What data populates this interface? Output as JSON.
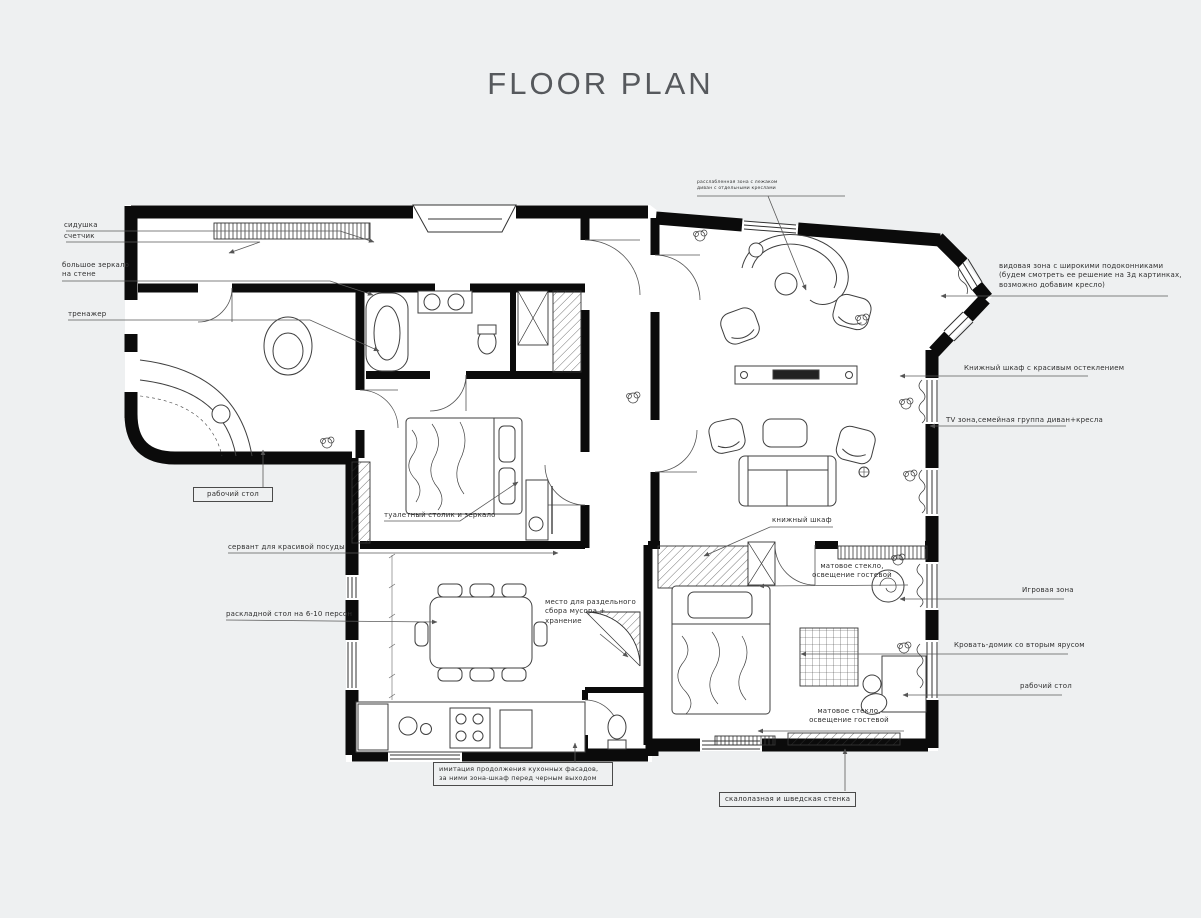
{
  "page": {
    "title": "FLOOR PLAN"
  },
  "colors": {
    "background": "#eef0f1",
    "paper": "#ffffff",
    "wall": "#0b0b0b",
    "furniture_line": "#3f3f3f",
    "leader_line": "#5a5a5a",
    "label_text": "#2f2f2f",
    "title_text": "#56595d"
  },
  "annotations": {
    "seat": {
      "text": "сидушка"
    },
    "meter": {
      "text": "счетчик"
    },
    "mirror": {
      "text": "большое зеркало\nна стене"
    },
    "trainer": {
      "text": "тренажер"
    },
    "desk_left": {
      "text": "рабочий стол"
    },
    "servant": {
      "text": "сервант для красивой посуды"
    },
    "folding_table": {
      "text": "раскладной стол на 6-10 персон"
    },
    "vanity": {
      "text": "туалетный столик и зеркало"
    },
    "waste": {
      "text": "место для раздельного\nсбора мусора +\nхранение"
    },
    "kitchen_facade": {
      "text": "имитация продолжения кухонных фасадов,\nза ними зона-шкаф перед черным выходом"
    },
    "lounge_note": {
      "text": "расслабленная зона с лежаком\nдиван с отдельными креслами"
    },
    "view_zone": {
      "text": "видовая зона с широкими подоконниками\n(будем смотреть ее решение на 3д картинках,\nвозможно добавим кресло)"
    },
    "bookcase_right": {
      "text": "Книжный шкаф с красивым остеклением"
    },
    "tv_zone": {
      "text": "TV зона,семейная группа диван+кресла"
    },
    "bookcase_small": {
      "text": "книжный шкаф"
    },
    "frosted_top": {
      "text": "матовое стекло,\nосвещение гостевой"
    },
    "play_zone": {
      "text": "Игровая зона"
    },
    "bed_house": {
      "text": "Кровать-домик со вторым ярусом"
    },
    "desk_right": {
      "text": "рабочий стол"
    },
    "frosted_bottom": {
      "text": "матовое стекло,\nосвещение гостевой"
    },
    "climbing": {
      "text": "скалолазная и шведская стенка"
    }
  }
}
